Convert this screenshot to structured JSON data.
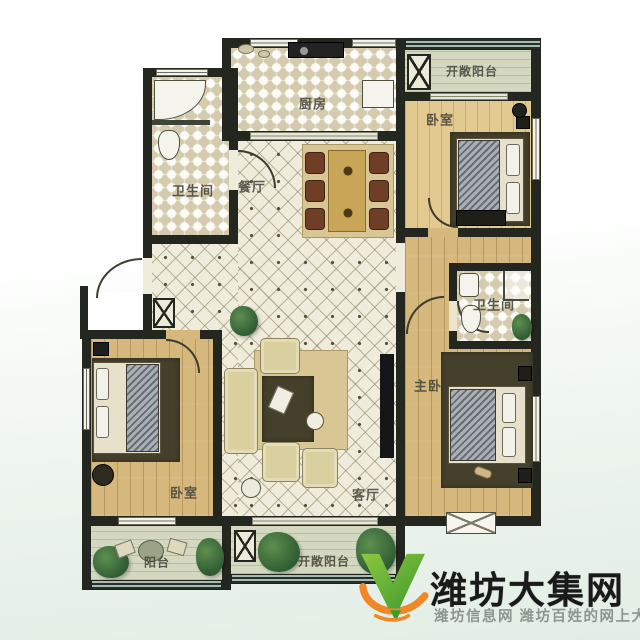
{
  "floorplan": {
    "rooms": {
      "kitchen": "厨房",
      "dining": "餐厅",
      "living": "客厅",
      "bath_left": "卫生间",
      "bath_right": "卫生间",
      "bedroom_top_right": "卧室",
      "bedroom_bottom_left": "卧室",
      "master_bedroom": "主卧",
      "balcony": "阳台",
      "open_balcony_top": "开敞阳台",
      "open_balcony_bottom": "开敞阳台"
    }
  },
  "watermark": {
    "site_name": "潍坊大集网",
    "tagline": "潍坊信息网 潍坊百姓的网上大集",
    "logo": "green-v-with-orange-swoosh"
  },
  "colors": {
    "wall": "#23271f",
    "tile": "#f0ecdc",
    "check": "#ece5cc",
    "wood": "#d6b77c",
    "wood_light": "#e2c98f",
    "balcony": "#d4d8c0",
    "rug_dark": "#45402b",
    "rug_light": "#d8c795",
    "sofa": "#d9cf9f",
    "table_wood": "#c9a558",
    "chair_brown": "#6e3f26",
    "plant_green": "#3b6b3d",
    "tv": "#14161a",
    "logo_green": "#55ad35",
    "logo_orange": "#f0882a",
    "text_dark": "#1a1a1a",
    "text_gray": "#8e948e"
  }
}
